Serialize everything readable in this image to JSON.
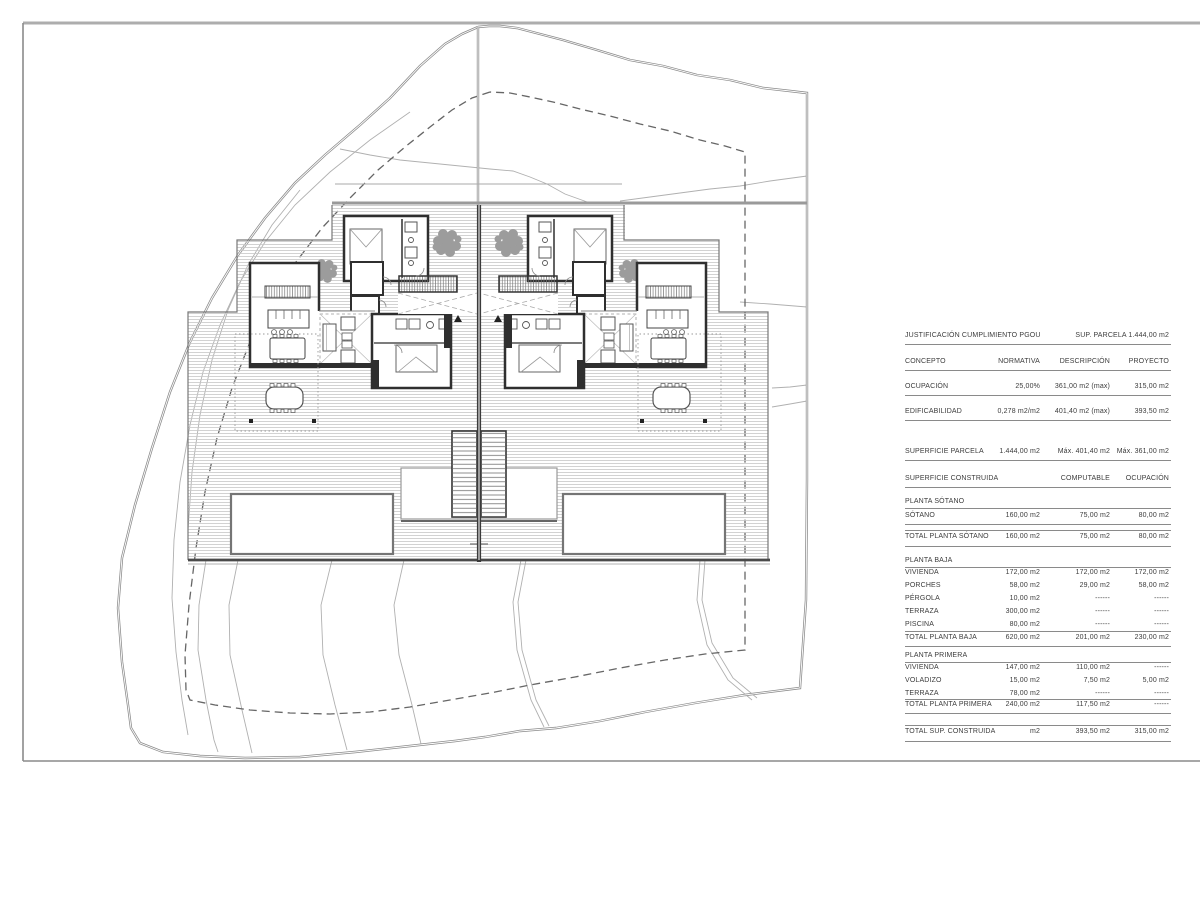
{
  "table": {
    "title": "JUSTIFICACIÓN CUMPLIMIENTO PGOU",
    "title_right": "SUP.  PARCELA  1.444,00 m2",
    "columns": [
      "CONCEPTO",
      "NORMATIVA",
      "DESCRIPCIÓN",
      "PROYECTO"
    ],
    "rows": [
      {
        "label": "OCUPACIÓN",
        "c1": "25,00%",
        "c2": "361,00 m2 (max)",
        "c3": "315,00 m2"
      },
      {
        "label": "EDIFICABILIDAD",
        "c1": "0,278 m2/m2",
        "c2": "401,40 m2 (max)",
        "c3": "393,50 m2"
      },
      {
        "label": "SUPERFICIE  PARCELA",
        "c1": "1.444,00 m2",
        "c2": "Máx. 401,40 m2",
        "c3": "Máx. 361,00 m2"
      },
      {
        "label": "SUPERFICIE  CONSTRUIDA",
        "c1": "",
        "c2": "COMPUTABLE",
        "c3": "OCUPACIÓN"
      },
      {
        "label": "PLANTA SÓTANO"
      },
      {
        "label": "SÓTANO",
        "c1": "160,00 m2",
        "c2": "75,00 m2",
        "c3": "80,00 m2"
      },
      {
        "label": "TOTAL PLANTA SÓTANO",
        "c1": "160,00 m2",
        "c2": "75,00 m2",
        "c3": "80,00 m2"
      },
      {
        "label": "PLANTA BAJA"
      },
      {
        "label": "VIVIENDA",
        "c1": "172,00 m2",
        "c2": "172,00 m2",
        "c3": "172,00 m2"
      },
      {
        "label": "PORCHES",
        "c1": "58,00 m2",
        "c2": "29,00 m2",
        "c3": "58,00 m2"
      },
      {
        "label": "PÉRGOLA",
        "c1": "10,00 m2",
        "c2": "------",
        "c3": "------"
      },
      {
        "label": "TERRAZA",
        "c1": "300,00 m2",
        "c2": "------",
        "c3": "------"
      },
      {
        "label": "PISCINA",
        "c1": "80,00 m2",
        "c2": "------",
        "c3": "------"
      },
      {
        "label": "TOTAL PLANTA BAJA",
        "c1": "620,00 m2",
        "c2": "201,00 m2",
        "c3": "230,00 m2"
      },
      {
        "label": "PLANTA PRIMERA"
      },
      {
        "label": "VIVIENDA",
        "c1": "147,00 m2",
        "c2": "110,00 m2",
        "c3": "------"
      },
      {
        "label": "VOLADIZO",
        "c1": "15,00 m2",
        "c2": "7,50 m2",
        "c3": "5,00 m2"
      },
      {
        "label": "TERRAZA",
        "c1": "78,00 m2",
        "c2": "------",
        "c3": "------"
      },
      {
        "label": "TOTAL PLANTA PRIMERA",
        "c1": "240,00 m2",
        "c2": "117,50 m2",
        "c3": "------"
      },
      {
        "label": "TOTAL SUP. CONSTRUIDA",
        "c1": "m2",
        "c2": "393,50 m2",
        "c3": "315,00 m2"
      }
    ]
  },
  "plan": {
    "houses": [
      "left-house",
      "right-house"
    ],
    "features": [
      "site-boundary",
      "setback-line",
      "terrain-contours",
      "deck-terrace",
      "swimming-pool-left",
      "swimming-pool-right",
      "central-staircase",
      "party-wall",
      "trees"
    ]
  },
  "colors": {
    "wall": "#2f2f2f",
    "boundary": "#8a8a8a",
    "deck_hatch": "#c6c6c6",
    "text": "#3c3c3c"
  }
}
